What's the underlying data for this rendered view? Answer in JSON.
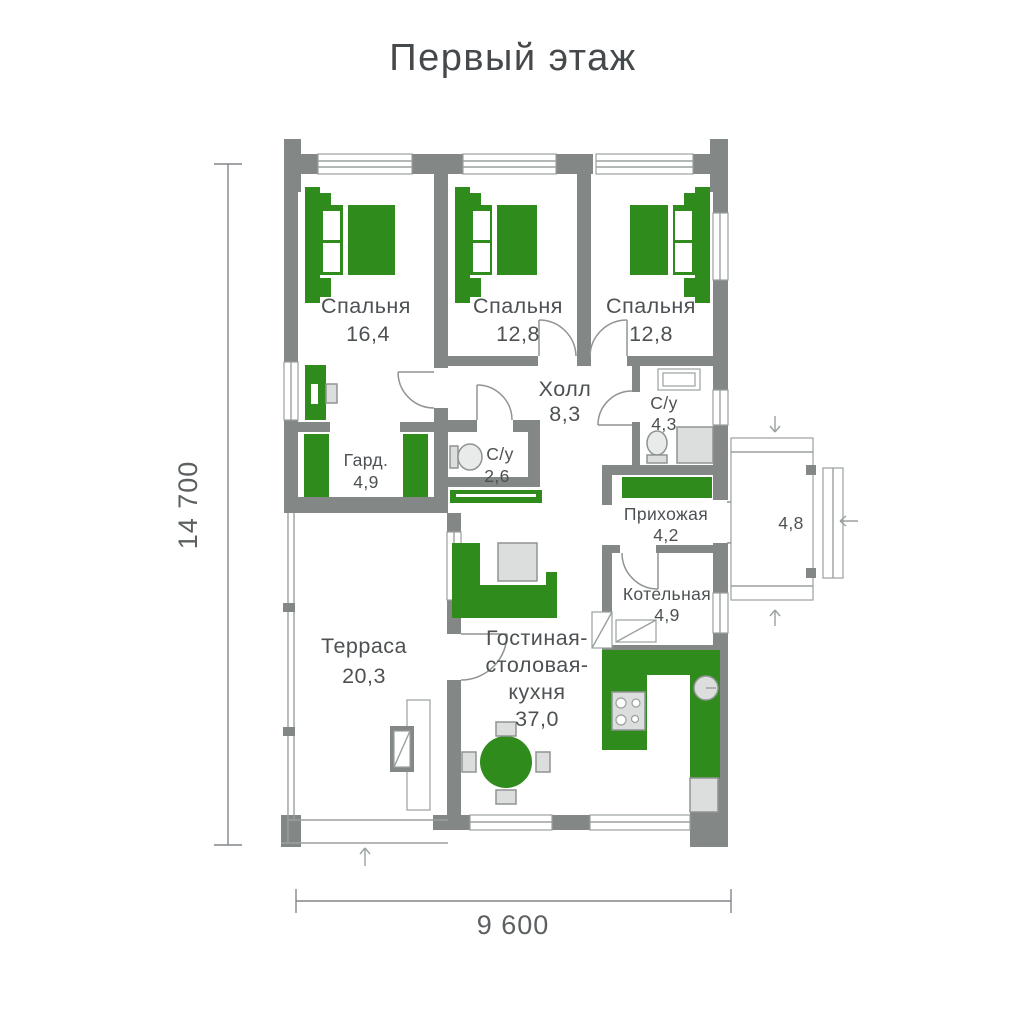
{
  "title": "Первый этаж",
  "dimensions": {
    "height": "14 700",
    "width": "9 600"
  },
  "rooms": {
    "bedroom1": {
      "label": "Спальня",
      "area": "16,4"
    },
    "bedroom2": {
      "label": "Спальня",
      "area": "12,8"
    },
    "bedroom3": {
      "label": "Спальня",
      "area": "12,8"
    },
    "hall": {
      "label": "Холл",
      "area": "8,3"
    },
    "bathroom_small": {
      "label": "С/у",
      "area": "2,6"
    },
    "bathroom": {
      "label": "С/у",
      "area": "4,3"
    },
    "wardrobe": {
      "label": "Гард.",
      "area": "4,9"
    },
    "entry": {
      "label": "Прихожая",
      "area": "4,2"
    },
    "porch": {
      "area": "4,8"
    },
    "boiler": {
      "label": "Котельная",
      "area": "4,9"
    },
    "terrace": {
      "label": "Терраса",
      "area": "20,3"
    },
    "living": {
      "line1": "Гостиная-",
      "line2": "столовая-",
      "line3": "кухня",
      "area": "37,0"
    }
  },
  "icons": {
    "bed": "double-bed top view with pillows and nightstands",
    "desk": "desk with chair",
    "wardrobe": "wardrobe cabinets",
    "toilet": "toilet top view",
    "sink": "washbasin",
    "shower": "shower tray",
    "bench": "hallway bench",
    "sofa": "corner sofa",
    "coffee-table": "square table",
    "dining-table": "round table with four chairs",
    "kitchen-counter": "L-shaped kitchen counter",
    "stove": "4-burner cooktop",
    "kitchen-sink": "round sink",
    "fridge": "refrigerator",
    "fireplace": "wood stove with chimney",
    "boiler": "boiler equipment",
    "entry-arrow": "entrance direction arrow"
  },
  "colors": {
    "wall": "#838785",
    "furniture": "#2f8b1c",
    "fixture": "#dcdedd",
    "line": "#9aa09d",
    "text": "#4d5153",
    "dimension_text": "#5c6062"
  }
}
